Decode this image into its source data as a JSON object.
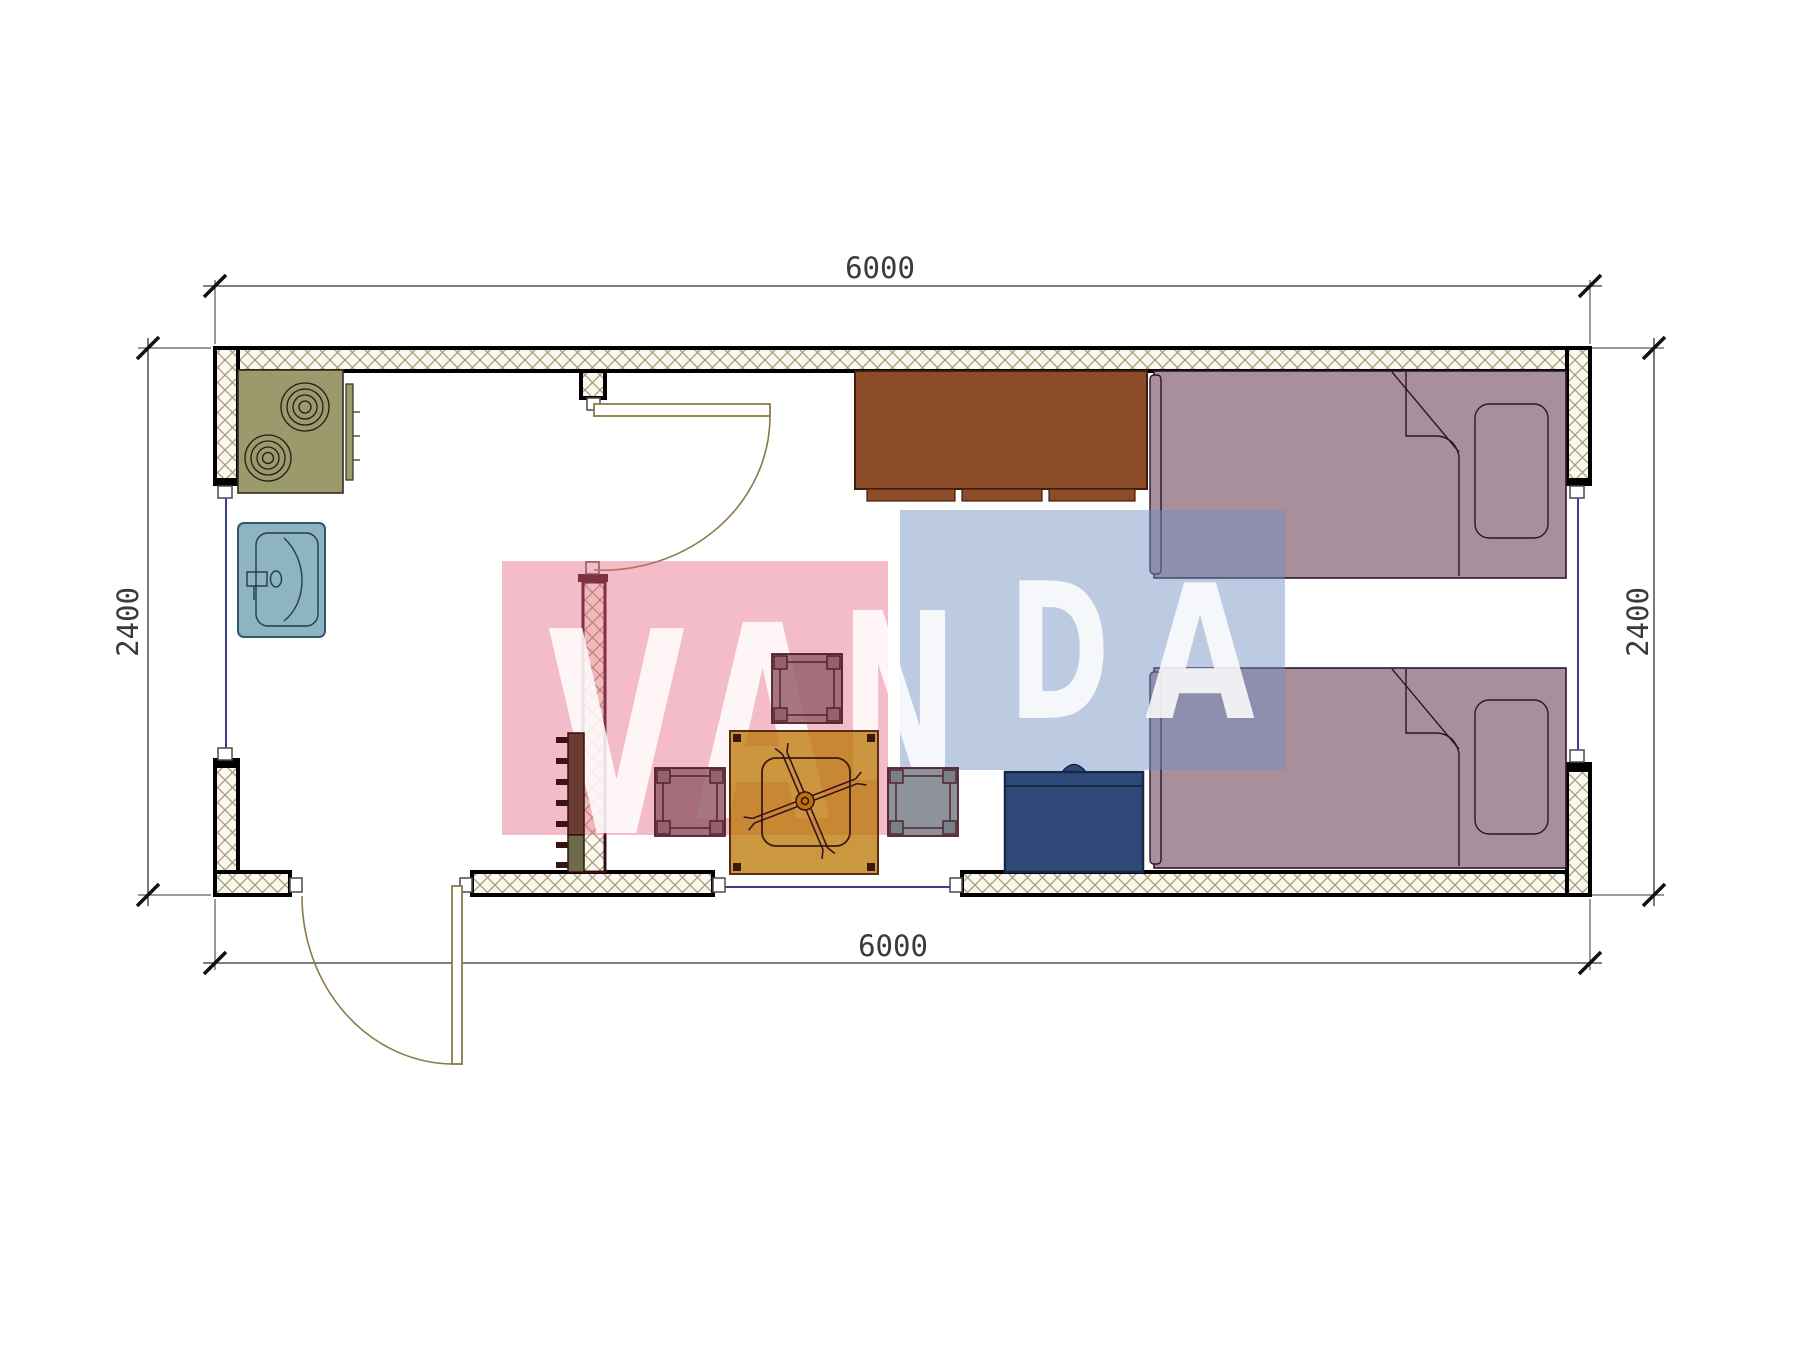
{
  "page": {
    "title": "Container house floor plan"
  },
  "dimensions": {
    "top": "6000",
    "bottom": "6000",
    "left": "2400",
    "right": "2400"
  },
  "watermark": {
    "text": "VANDA",
    "letters": [
      "V",
      "A",
      "N",
      "D",
      "A"
    ]
  },
  "furniture_items": [
    "stove",
    "sink",
    "desk",
    "bed-top",
    "bed-bottom",
    "chest",
    "table-with-fan",
    "stool-top",
    "stool-left",
    "stool-right",
    "ladder-rack"
  ],
  "colors": {
    "wall-fill": "#faf7ee",
    "hatch-line": "#a59872",
    "wall-stroke": "#000000",
    "partition-stroke": "#331019",
    "bed": "#a78f9c",
    "bed-line": "#2c1430",
    "desk": "#8d4c28",
    "desk-line": "#3f1d0c",
    "stove": "#9c9a6c",
    "stove-line": "#2f2f20",
    "burner-line": "#1d1d14",
    "sink": "#8fb4c1",
    "sink-line": "#2e5b69",
    "sink-detail": "#1d3c4c",
    "chest": "#2f4a79",
    "chest-line": "#152848",
    "table": "#b97500",
    "table-line": "#5a2a12",
    "table-detail": "#3a1a0e",
    "fan-line": "#3b1020",
    "stool-purple": "#96606c",
    "stool-gray": "#7a7f88",
    "stool-line": "#4c1f2b",
    "ladder-top": "#6b3a33",
    "ladder-bottom": "#6f6b4a",
    "ladder-line": "#30130d",
    "ladder-tick": "#3a150f",
    "window-line": "#3b3e8f",
    "door-line": "#8a7a4a",
    "dim-line": "#333333",
    "dim-tick": "#111111",
    "dim-text": "#3a3a3a",
    "wm-pink": "rgba(229,95,124,0.42)",
    "wm-blue": "rgba(113,145,194,0.47)",
    "wm-letter": "rgba(255,255,255,0.85)"
  }
}
